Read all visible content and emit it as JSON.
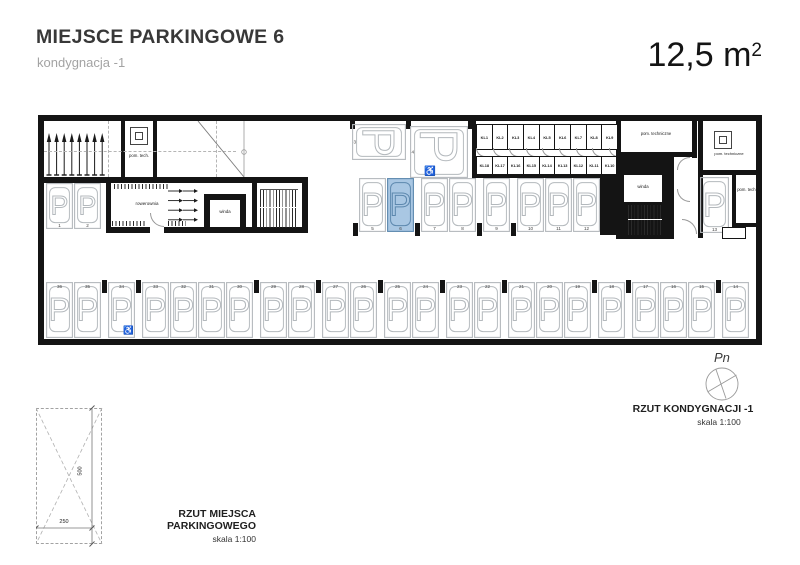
{
  "header": {
    "title": "MIEJSCE PARKINGOWE 6",
    "subtitle": "kondygnacja -1",
    "area_value": "12,5 m",
    "area_exponent": "2"
  },
  "plan": {
    "rooms": {
      "pom_tech": "pom. tech.",
      "rowerownia": "rowerownia",
      "winda": "winda",
      "pom_techniczne": "pom. techniczne"
    },
    "lockers": {
      "top": [
        "KL1",
        "KL2",
        "KL3",
        "KL4",
        "KL5",
        "KL6",
        "KL7",
        "KL8",
        "KL9"
      ],
      "bottom": [
        "KL18",
        "KL17",
        "KL16",
        "KL15",
        "KL14",
        "KL13",
        "KL12",
        "KL11",
        "KL10"
      ]
    },
    "parking": {
      "left": [
        {
          "n": "1"
        },
        {
          "n": "2"
        }
      ],
      "top_horizontal": [
        {
          "n": "3"
        },
        {
          "n": "4",
          "disabled": true
        }
      ],
      "middle": [
        {
          "n": "5"
        },
        {
          "n": "6",
          "highlight": true
        },
        {
          "n": "7"
        },
        {
          "n": "8"
        },
        {
          "n": "9"
        },
        {
          "n": "10"
        },
        {
          "n": "11"
        },
        {
          "n": "12"
        }
      ],
      "right": [
        {
          "n": "13"
        }
      ],
      "bottom": [
        {
          "n": "36"
        },
        {
          "n": "35"
        },
        {
          "n": "34",
          "disabled": true
        },
        {
          "n": "33"
        },
        {
          "n": "32"
        },
        {
          "n": "31"
        },
        {
          "n": "30"
        },
        {
          "n": "29"
        },
        {
          "n": "28"
        },
        {
          "n": "27"
        },
        {
          "n": "26"
        },
        {
          "n": "25"
        },
        {
          "n": "24"
        },
        {
          "n": "23"
        },
        {
          "n": "22"
        },
        {
          "n": "21"
        },
        {
          "n": "20"
        },
        {
          "n": "19"
        },
        {
          "n": "18"
        },
        {
          "n": "17"
        },
        {
          "n": "16"
        },
        {
          "n": "15"
        },
        {
          "n": "14"
        }
      ]
    },
    "highlighted_space": "6"
  },
  "detail": {
    "caption": "RZUT MIEJSCA PARKINGOWEGO",
    "scale": "skala 1:100",
    "width_label": "250",
    "height_label": "500"
  },
  "plan_caption": {
    "compass_label": "Pn",
    "title": "RZUT KONDYGNACJI -1",
    "scale": "skala 1:100"
  },
  "colors": {
    "highlight_fill": "#a9c7e3",
    "highlight_stroke": "#5d88ae",
    "outline": "#b4b9bd",
    "wall": "#141414"
  }
}
